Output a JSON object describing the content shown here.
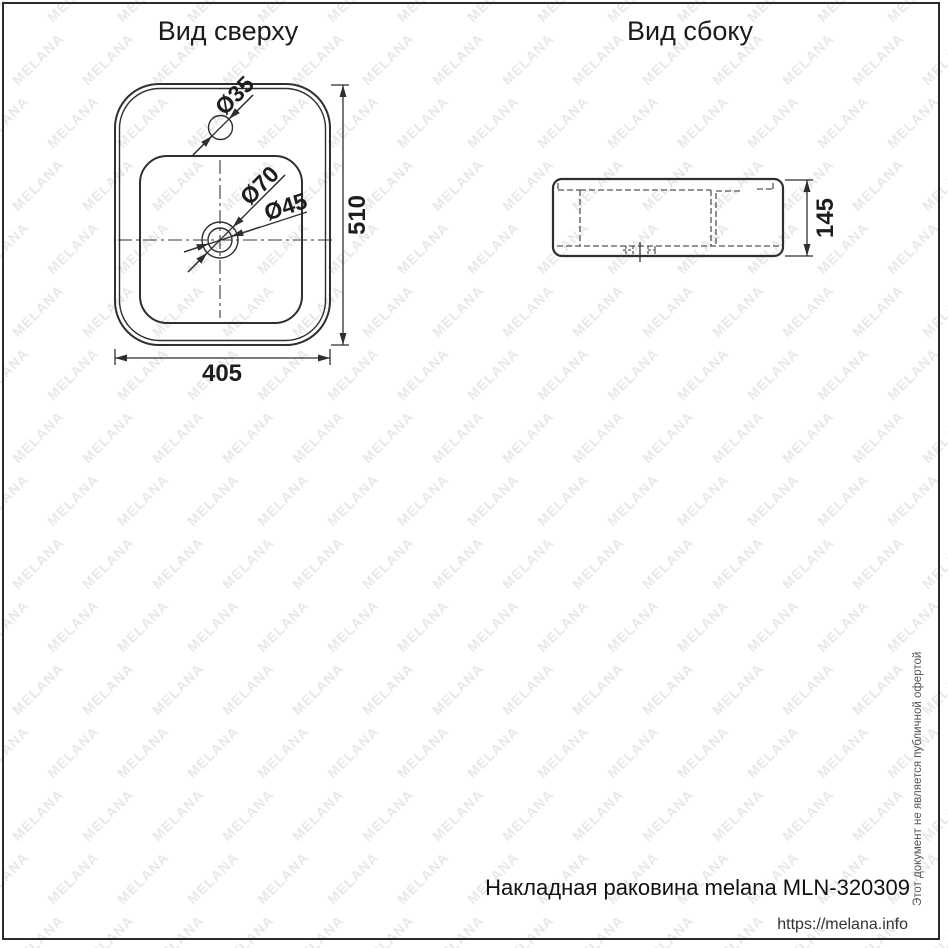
{
  "page": {
    "watermark_text": "MELANA",
    "watermark_color": "#e8e8e8",
    "vertical_notice": "Этот документ не является публичной офертой",
    "footer_product": "Накладная раковина melana MLN-320309",
    "footer_url": "https://melana.info"
  },
  "top_view": {
    "title": "Вид сверху",
    "dim_width": "405",
    "dim_height": "510",
    "label_faucet_hole": "Ø35",
    "label_drain_outer": "Ø70",
    "label_drain_inner": "Ø45"
  },
  "side_view": {
    "title": "Вид сбоку",
    "dim_height": "145"
  }
}
